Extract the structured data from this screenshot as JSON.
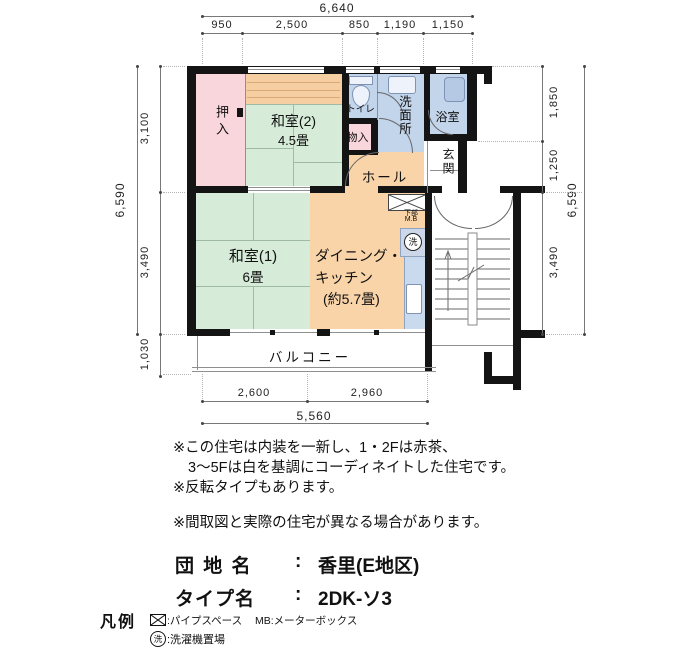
{
  "plan": {
    "dims": {
      "top_total": "6,640",
      "top_segments": [
        "950",
        "2,500",
        "850",
        "1,190",
        "1,150"
      ],
      "left_total": "6,590",
      "left_segments": [
        "3,100",
        "3,490",
        "1,030"
      ],
      "right_segments": [
        "1,850",
        "1,250",
        "3,490"
      ],
      "right_total": "6,590",
      "bottom_segments": [
        "2,600",
        "2,960"
      ],
      "bottom_total": "5,560"
    },
    "rooms": {
      "oshiire": "押入",
      "washitsu2": "和室(2)",
      "washitsu2_size": "4.5畳",
      "toilet": "トイレ",
      "storage": "物入",
      "washroom": "洗面所",
      "bath": "浴室",
      "hall": "ホール",
      "entrance": "玄関",
      "washitsu1": "和室(1)",
      "washitsu1_size": "6畳",
      "dk_line1": "ダイニング・",
      "dk_line2": "キッチン",
      "dk_line3": "(約5.7畳)",
      "balcony": "バルコニー",
      "mb_line1": "下部",
      "mb_line2": "M.B",
      "washer_symbol": "洗"
    }
  },
  "notes": {
    "line1": "※この住宅は内装を一新し、1・2Fは赤茶、",
    "line2": "3〜5Fは白を基調にコーディネイトした住宅です。",
    "line3": "※反転タイプもあります。",
    "line4": "※間取図と実際の住宅が異なる場合があります。"
  },
  "info": {
    "danchi_label": "団 地 名",
    "danchi_colon": ":",
    "danchi_value": "香里(E地区)",
    "type_label": "タイプ名",
    "type_colon": ":",
    "type_value": "2DK-ソ3"
  },
  "legend": {
    "title": "凡例",
    "ps_text": ":パイプスペース",
    "mb_text": "MB:メーターボックス",
    "washer_symbol": "洗",
    "washer_text": ":洗濯機置場"
  },
  "colors": {
    "wall": "#141414",
    "tatami": "#d6ebd8",
    "closet_pink": "#f8d6dc",
    "wet_blue": "#c3d5eb",
    "wood_orange": "#f9d4a8",
    "dim_line": "#787878"
  }
}
